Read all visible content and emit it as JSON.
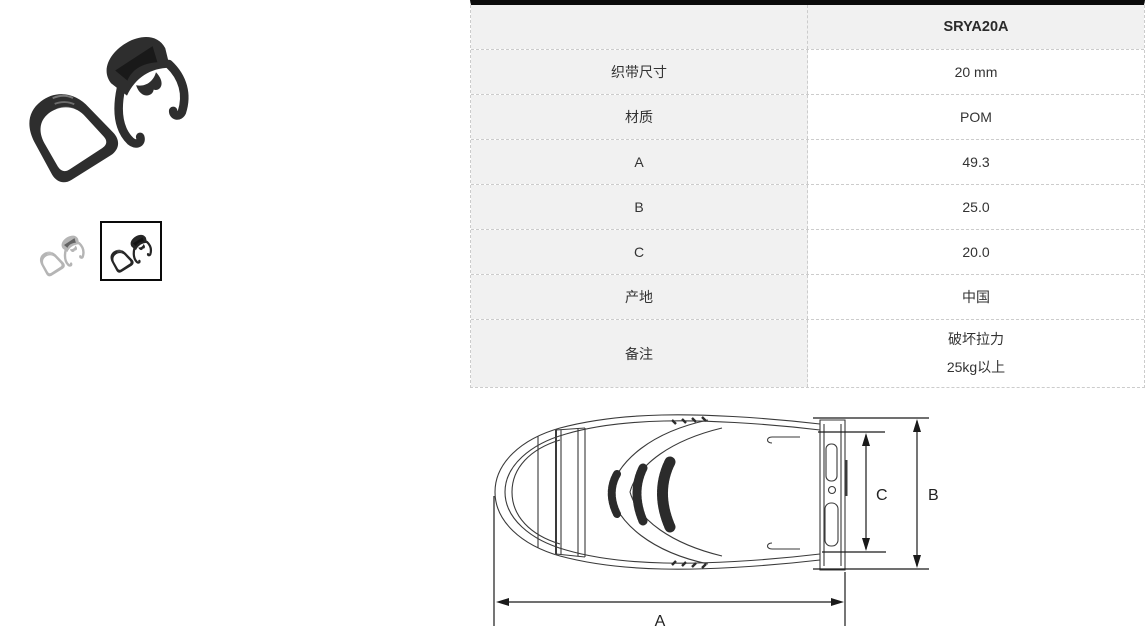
{
  "table": {
    "model": "SRYA20A",
    "rows": [
      {
        "label": "织带尺寸",
        "value": "20 mm"
      },
      {
        "label": "材质",
        "value": "POM"
      },
      {
        "label": "A",
        "value": "49.3"
      },
      {
        "label": "B",
        "value": "25.0"
      },
      {
        "label": "C",
        "value": "20.0"
      },
      {
        "label": "产地",
        "value": "中国"
      },
      {
        "label": "备注",
        "value": "破坏拉力\n25kg以上"
      }
    ]
  },
  "drawing": {
    "labels": {
      "a": "A",
      "b": "B",
      "c": "C"
    }
  },
  "gallery": {
    "variants": [
      {
        "name": "gray"
      },
      {
        "name": "black",
        "selected": true
      }
    ]
  },
  "colors": {
    "table_top_bar": "#0b0b0b",
    "row_label_bg": "#f1f1f1",
    "dashed_border": "#cccccc",
    "text": "#333333",
    "product_black": "#2e2e2e",
    "product_gray": "#b5b5b5"
  }
}
